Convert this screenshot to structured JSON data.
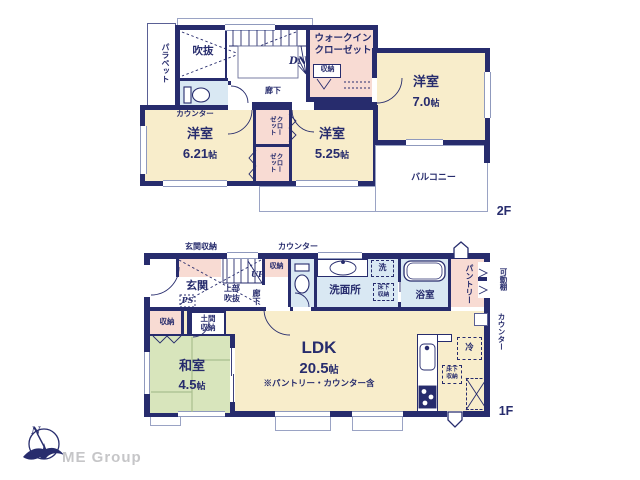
{
  "palette": {
    "wall_navy": "#272c6d",
    "room_cream": "#f8edcb",
    "closet_pink": "#f8dbd3",
    "wet_area_blue": "#d9e8f3",
    "tatami_green": "#d8e5bc",
    "thin_outline": "#9aa3c4",
    "logo_gray": "#c6c6c8"
  },
  "floor2": {
    "label": "2F",
    "parapet": "パラペット",
    "void": "吹抜",
    "dn": "DN",
    "wic": [
      "ウォークイン",
      "クローゼット"
    ],
    "storage": "収納",
    "hallway": "廊下",
    "counter": "カウンター",
    "closet": "クローゼット",
    "bedroom1": {
      "name": "洋室",
      "size": "6.21",
      "unit": "帖"
    },
    "bedroom2": {
      "name": "洋室",
      "size": "5.25",
      "unit": "帖"
    },
    "bedroom3": {
      "name": "洋室",
      "size": "7.0",
      "unit": "帖"
    },
    "balcony": "バルコニー"
  },
  "floor1": {
    "label": "1F",
    "entrance_storage": "玄関収納",
    "counter_top": "カウンター",
    "entrance": "玄関",
    "ps": "PS",
    "up": "UP",
    "open_above": [
      "上部",
      "吹抜"
    ],
    "hallway": "廊下",
    "storage": "収納",
    "washroom": "洗面所",
    "washer": "洗",
    "underfloor": [
      "床下",
      "収納"
    ],
    "bath": "浴室",
    "pantry": "パントリー",
    "movable_shelf": "可動棚",
    "counter_right": "カウンター",
    "fridge": "冷",
    "tatami_storage": "収納",
    "doma": [
      "土間",
      "収納"
    ],
    "washitsu": {
      "name": "和室",
      "size": "4.5",
      "unit": "帖"
    },
    "ldk": {
      "name": "LDK",
      "size": "20.5",
      "unit": "帖",
      "note": "※パントリー・カウンター含"
    }
  },
  "logo": {
    "company": "ME Group",
    "north": "N"
  }
}
